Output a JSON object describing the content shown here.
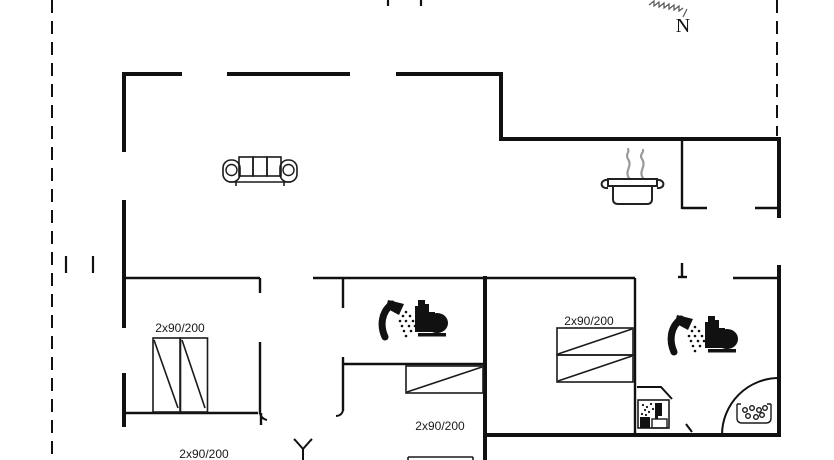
{
  "plan": {
    "compass": {
      "label": "N"
    },
    "labels": {
      "left_bedroom_bed": "2x90/200",
      "middle_bedroom_bed": "2x90/200",
      "right_bedroom_bed": "2x90/200",
      "bottom_bedroom_bed": "2x90/200"
    },
    "colors": {
      "wall": "#111111",
      "label": "#1a1a1a",
      "steam": "#9a9a9a",
      "background": "#ffffff",
      "icon": "#111111"
    }
  }
}
